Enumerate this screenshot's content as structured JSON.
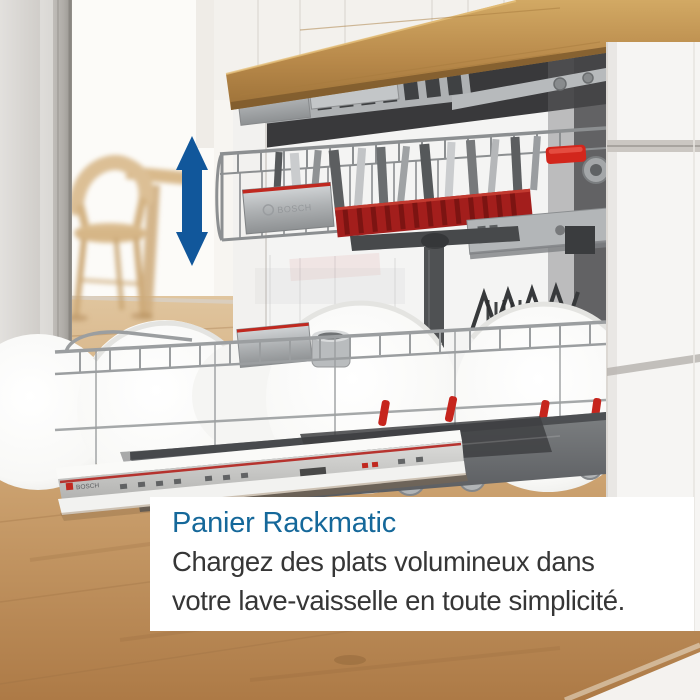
{
  "caption": {
    "title": "Panier Rackmatic",
    "body_line1": "Chargez des plats volumineux dans",
    "body_line2": "votre lave-vaisselle en toute simplicité."
  },
  "branding": {
    "rack_box_logo": "BOSCH",
    "door_logo": "BOSCH"
  },
  "arrow": {
    "type": "vertical-double-arrow",
    "color": "#11579b"
  },
  "palette": {
    "caption_title": "#15689a",
    "caption_body": "#363636",
    "card_background": "#ffffff",
    "bosch_red": "#c0281f",
    "counter_wood": "#b98a4a",
    "floor_wood": "#c2915f",
    "cabinet_white": "#f6f5f3"
  }
}
